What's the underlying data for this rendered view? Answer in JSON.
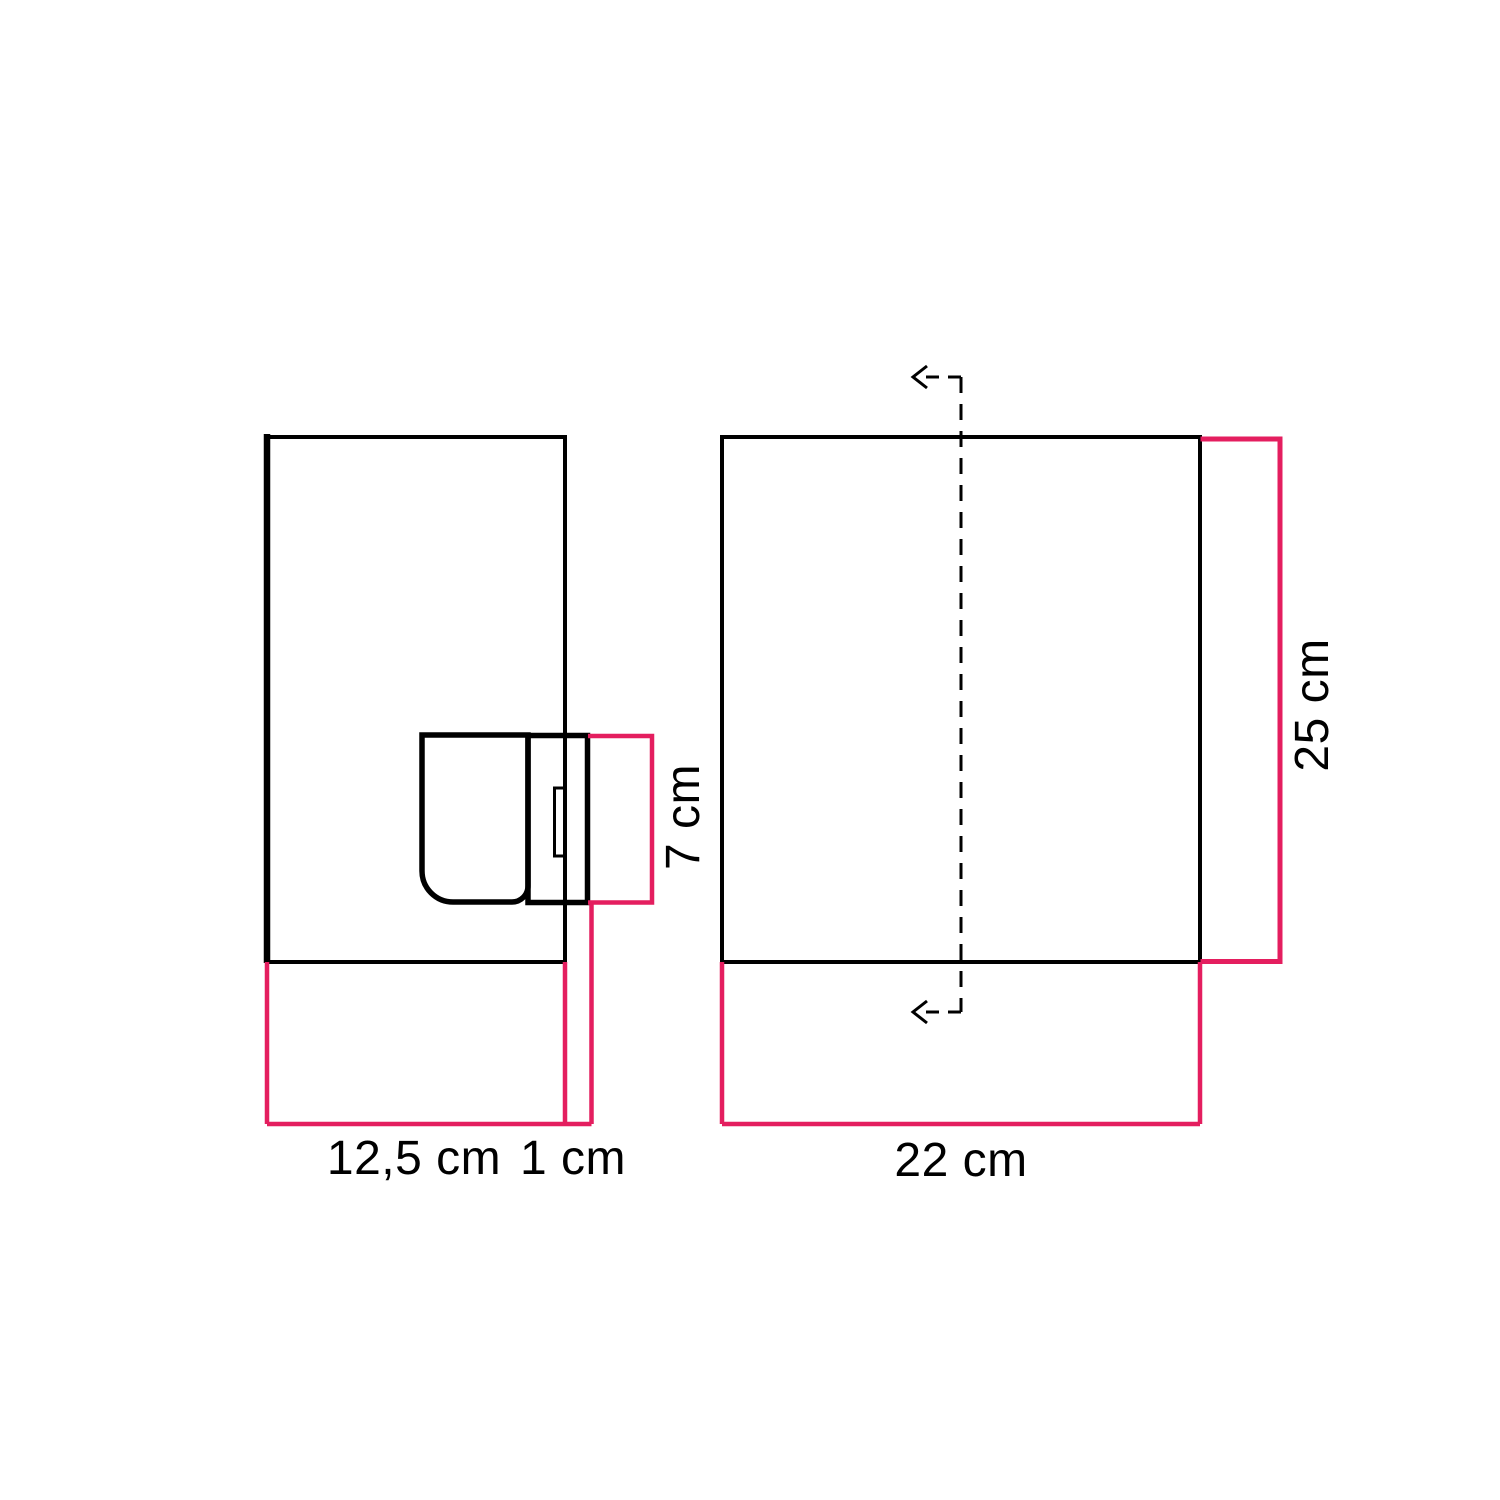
{
  "canvas": {
    "background": "#ffffff",
    "width": 1500,
    "height": 1500
  },
  "colors": {
    "outline": "#000000",
    "dimension_line": "#e41e5f",
    "label_text": "#000000"
  },
  "side_view": {
    "labels": {
      "depth": "12,5 cm",
      "wall_gap": "1 cm",
      "socket_height": "7 cm"
    }
  },
  "front_view": {
    "labels": {
      "width": "22 cm",
      "height": "25 cm"
    }
  },
  "icons": {
    "section_arrow": "arrow-left"
  }
}
